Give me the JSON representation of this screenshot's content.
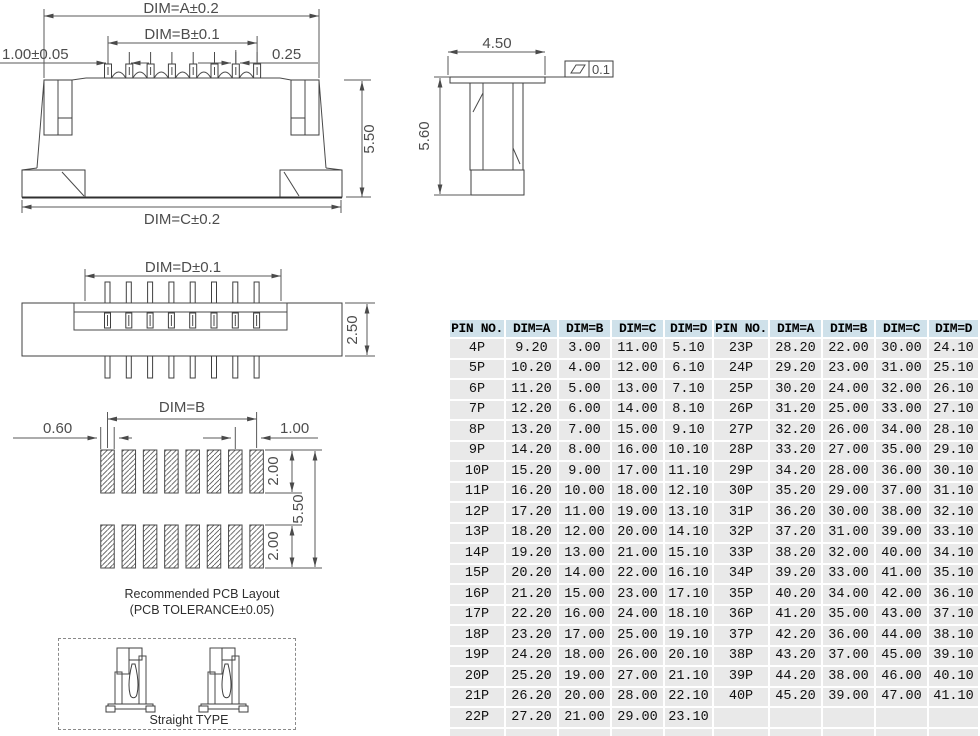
{
  "drawings": {
    "front_view": {
      "dim_a": "DIM=A±0.2",
      "dim_b": "DIM=B±0.1",
      "pitch": "1.00±0.05",
      "pin_width": "0.25",
      "height": "5.50",
      "dim_c": "DIM=C±0.2"
    },
    "side_view": {
      "width": "4.50",
      "height": "5.60",
      "flatness": "0.1"
    },
    "top_view": {
      "dim_d": "DIM=D±0.1",
      "thickness": "2.50"
    },
    "pcb_layout": {
      "dim_b": "DIM=B",
      "pad_width": "0.60",
      "pad_pitch": "1.00",
      "pad_len_top": "2.00",
      "pad_len_bottom": "2.00",
      "row_span": "5.50",
      "caption_line1": "Recommended PCB Layout",
      "caption_line2": "(PCB TOLERANCE±0.05)"
    },
    "straight_type_label": "Straight TYPE"
  },
  "table": {
    "header_bg": "#cfe1ea",
    "row_bg": "#e9e9e9",
    "headers": [
      "PIN NO.",
      "DIM=A",
      "DIM=B",
      "DIM=C",
      "DIM=D",
      "PIN NO.",
      "DIM=A",
      "DIM=B",
      "DIM=C",
      "DIM=D"
    ],
    "rows": [
      [
        "4P",
        "9.20",
        "3.00",
        "11.00",
        "5.10",
        "23P",
        "28.20",
        "22.00",
        "30.00",
        "24.10"
      ],
      [
        "5P",
        "10.20",
        "4.00",
        "12.00",
        "6.10",
        "24P",
        "29.20",
        "23.00",
        "31.00",
        "25.10"
      ],
      [
        "6P",
        "11.20",
        "5.00",
        "13.00",
        "7.10",
        "25P",
        "30.20",
        "24.00",
        "32.00",
        "26.10"
      ],
      [
        "7P",
        "12.20",
        "6.00",
        "14.00",
        "8.10",
        "26P",
        "31.20",
        "25.00",
        "33.00",
        "27.10"
      ],
      [
        "8P",
        "13.20",
        "7.00",
        "15.00",
        "9.10",
        "27P",
        "32.20",
        "26.00",
        "34.00",
        "28.10"
      ],
      [
        "9P",
        "14.20",
        "8.00",
        "16.00",
        "10.10",
        "28P",
        "33.20",
        "27.00",
        "35.00",
        "29.10"
      ],
      [
        "10P",
        "15.20",
        "9.00",
        "17.00",
        "11.10",
        "29P",
        "34.20",
        "28.00",
        "36.00",
        "30.10"
      ],
      [
        "11P",
        "16.20",
        "10.00",
        "18.00",
        "12.10",
        "30P",
        "35.20",
        "29.00",
        "37.00",
        "31.10"
      ],
      [
        "12P",
        "17.20",
        "11.00",
        "19.00",
        "13.10",
        "31P",
        "36.20",
        "30.00",
        "38.00",
        "32.10"
      ],
      [
        "13P",
        "18.20",
        "12.00",
        "20.00",
        "14.10",
        "32P",
        "37.20",
        "31.00",
        "39.00",
        "33.10"
      ],
      [
        "14P",
        "19.20",
        "13.00",
        "21.00",
        "15.10",
        "33P",
        "38.20",
        "32.00",
        "40.00",
        "34.10"
      ],
      [
        "15P",
        "20.20",
        "14.00",
        "22.00",
        "16.10",
        "34P",
        "39.20",
        "33.00",
        "41.00",
        "35.10"
      ],
      [
        "16P",
        "21.20",
        "15.00",
        "23.00",
        "17.10",
        "35P",
        "40.20",
        "34.00",
        "42.00",
        "36.10"
      ],
      [
        "17P",
        "22.20",
        "16.00",
        "24.00",
        "18.10",
        "36P",
        "41.20",
        "35.00",
        "43.00",
        "37.10"
      ],
      [
        "18P",
        "23.20",
        "17.00",
        "25.00",
        "19.10",
        "37P",
        "42.20",
        "36.00",
        "44.00",
        "38.10"
      ],
      [
        "19P",
        "24.20",
        "18.00",
        "26.00",
        "20.10",
        "38P",
        "43.20",
        "37.00",
        "45.00",
        "39.10"
      ],
      [
        "20P",
        "25.20",
        "19.00",
        "27.00",
        "21.10",
        "39P",
        "44.20",
        "38.00",
        "46.00",
        "40.10"
      ],
      [
        "21P",
        "26.20",
        "20.00",
        "28.00",
        "22.10",
        "40P",
        "45.20",
        "39.00",
        "47.00",
        "41.10"
      ],
      [
        "22P",
        "27.20",
        "21.00",
        "29.00",
        "23.10",
        "",
        "",
        "",
        "",
        ""
      ]
    ]
  }
}
